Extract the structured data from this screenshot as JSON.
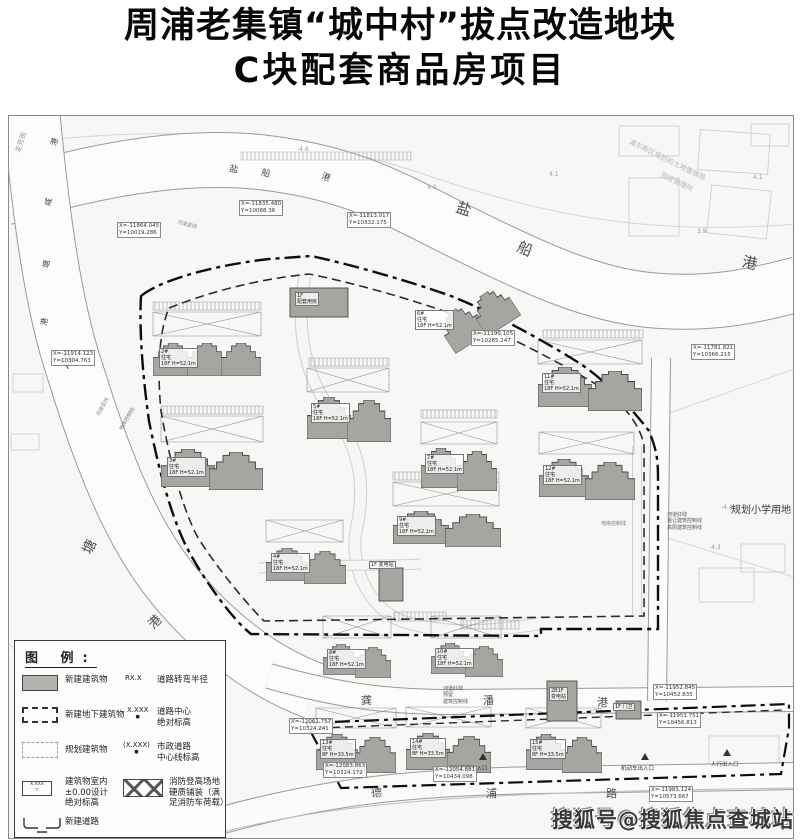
{
  "title": {
    "line1": "周浦老集镇“城中村”拔点改造地块",
    "line2": "C块配套商品房项目"
  },
  "watermark": "搜狐号@搜狐焦点查城站",
  "legend": {
    "title": "图 例:",
    "elev_symbol": "X.XXX",
    "rows": [
      {
        "label": "新建建筑物",
        "sym": "RX.X",
        "symlabel": "道路转弯半径"
      },
      {
        "label": "新建地下建筑物",
        "sym": "X.XXX",
        "dot": "●",
        "symlabel": "道路中心\n绝对标高"
      },
      {
        "label": "规划建筑物",
        "sym": "(X.XXX)",
        "dot": "●",
        "symlabel": "市政道路\n中心线标高"
      },
      {
        "label": "建筑物室内\n±0.00设计\n绝对标高",
        "symlabel": "消防登高场地\n硬质铺装（满\n足消防车荷载）"
      },
      {
        "label": "新建道路"
      }
    ]
  },
  "chars": [
    {
      "t": "盐",
      "x": 447,
      "y": 86,
      "s": 15,
      "r": 18
    },
    {
      "t": "船",
      "x": 508,
      "y": 126,
      "s": 15,
      "r": 24
    },
    {
      "t": "港",
      "x": 733,
      "y": 140,
      "s": 15,
      "r": 12
    },
    {
      "t": "盐",
      "x": 220,
      "y": 50,
      "s": 9,
      "r": 10
    },
    {
      "t": "船",
      "x": 252,
      "y": 54,
      "s": 9,
      "r": 14
    },
    {
      "t": "港",
      "x": 312,
      "y": 58,
      "s": 9,
      "r": 18
    },
    {
      "t": "港",
      "x": 42,
      "y": 22,
      "s": 8,
      "r": -70
    },
    {
      "t": "咸",
      "x": 36,
      "y": 82,
      "s": 8,
      "r": -75
    },
    {
      "t": "塘",
      "x": 34,
      "y": 144,
      "s": 8,
      "r": -80
    },
    {
      "t": "港",
      "x": 32,
      "y": 202,
      "s": 8,
      "r": -80
    },
    {
      "t": "咸",
      "x": 52,
      "y": 238,
      "s": 14,
      "r": -55
    },
    {
      "t": "塘",
      "x": 74,
      "y": 424,
      "s": 14,
      "r": -65
    },
    {
      "t": "港",
      "x": 140,
      "y": 500,
      "s": 13,
      "r": -45
    },
    {
      "t": "龚",
      "x": 352,
      "y": 579,
      "s": 11,
      "r": 0
    },
    {
      "t": "潘",
      "x": 474,
      "y": 579,
      "s": 11,
      "r": 0
    },
    {
      "t": "港",
      "x": 588,
      "y": 581,
      "s": 11,
      "r": 0
    },
    {
      "t": "德",
      "x": 362,
      "y": 671,
      "s": 11,
      "r": 0
    },
    {
      "t": "浦",
      "x": 477,
      "y": 672,
      "s": 11,
      "r": 0
    },
    {
      "t": "路",
      "x": 597,
      "y": 672,
      "s": 11,
      "r": 0
    }
  ],
  "tinylabels": [
    {
      "t": "规划小学用地",
      "x": 722,
      "y": 389,
      "s": 10,
      "c": "#3a3a3a"
    },
    {
      "t": "浦东新区规划和土地管理局",
      "x": 616,
      "y": 40,
      "s": 7,
      "r": 26,
      "c": "#b5b5b2"
    },
    {
      "t": "测绘管理所",
      "x": 650,
      "y": 62,
      "s": 7,
      "r": 26,
      "c": "#b5b5b2"
    },
    {
      "t": "走芳街",
      "x": 2,
      "y": 22,
      "s": 7,
      "r": -72,
      "c": "#999"
    },
    {
      "t": "河道蓝线",
      "x": 168,
      "y": 106,
      "s": 5,
      "r": 14,
      "c": "#888"
    },
    {
      "t": "河道蓝线",
      "x": 84,
      "y": 288,
      "s": 5,
      "r": -62,
      "c": "#888"
    },
    {
      "t": "河道红线\n预留\n建筑控制线",
      "x": 434,
      "y": 570,
      "s": 5,
      "c": "#555"
    },
    {
      "t": "河道红线\n退让建筑控制线\n高层建筑控制线",
      "x": 658,
      "y": 396,
      "s": 5,
      "c": "#555"
    },
    {
      "t": "地库控制线",
      "x": 592,
      "y": 405,
      "s": 5,
      "c": "#777"
    },
    {
      "t": "地库控制线",
      "x": 106,
      "y": 300,
      "s": 5,
      "r": -60,
      "c": "#777"
    },
    {
      "t": "机动车出入口",
      "x": 612,
      "y": 650,
      "s": 5.5,
      "c": "#333"
    },
    {
      "t": "人行出入口",
      "x": 702,
      "y": 646,
      "s": 5.5,
      "c": "#333"
    },
    {
      "t": "消防登高出入口",
      "x": 440,
      "y": 650,
      "s": 5.5,
      "c": "#333"
    },
    {
      "t": "4.1",
      "x": 540,
      "y": 55,
      "s": 6,
      "c": "#999"
    },
    {
      "t": "4.0",
      "x": 418,
      "y": 68,
      "s": 6,
      "c": "#999"
    },
    {
      "t": "-4.6",
      "x": 288,
      "y": 30,
      "s": 6,
      "c": "#999"
    },
    {
      "t": "3.9",
      "x": 688,
      "y": 112,
      "s": 6,
      "c": "#999"
    },
    {
      "t": "-4.1",
      "x": 742,
      "y": 58,
      "s": 6,
      "c": "#999"
    },
    {
      "t": "-4.4",
      "x": 712,
      "y": 388,
      "s": 6,
      "c": "#999"
    },
    {
      "t": "-4.3",
      "x": 700,
      "y": 428,
      "s": 6,
      "c": "#999"
    },
    {
      "t": "1.6",
      "x": 552,
      "y": 692,
      "s": 6,
      "c": "#999"
    }
  ],
  "coords": [
    {
      "t": "X=-11835.480\nY=10088.36",
      "x": 230,
      "y": 84
    },
    {
      "t": "X=-11813.017\nY=10332.175",
      "x": 338,
      "y": 96
    },
    {
      "t": "X=-11864.045\nY=10019.286",
      "x": 108,
      "y": 106
    },
    {
      "t": "X=-11190.105\nY=10285.247",
      "x": 462,
      "y": 214
    },
    {
      "t": "X=-11781.821\nY=10366.215",
      "x": 682,
      "y": 228
    },
    {
      "t": "X=-11914.123\nY=10304.763",
      "x": 42,
      "y": 234
    },
    {
      "t": "X=-11952.845\nY=10452.835",
      "x": 644,
      "y": 568
    },
    {
      "t": "X=-11951.751\nY=10456.813",
      "x": 648,
      "y": 596
    },
    {
      "t": "X=-11983.124\nY=10573.667",
      "x": 640,
      "y": 670
    },
    {
      "t": "X=-12083.863\nY=10324.172",
      "x": 314,
      "y": 646
    },
    {
      "t": "X=-12061.757\nY=10324.241",
      "x": 280,
      "y": 602
    },
    {
      "t": "X=-12054.881\nY=10434.098",
      "x": 424,
      "y": 650
    }
  ],
  "building_labels": [
    {
      "t": "2#\n住宅\n18F H=52.1m",
      "x": 150,
      "y": 232
    },
    {
      "t": "3#\n住宅\n18F H=52.1m",
      "x": 158,
      "y": 341
    },
    {
      "t": "4#\n住宅\n18F H=52.1m",
      "x": 262,
      "y": 437
    },
    {
      "t": "5#\n住宅\n18F H=52.1m",
      "x": 302,
      "y": 287
    },
    {
      "t": "6#\n住宅\n18F H=52.1m",
      "x": 406,
      "y": 194
    },
    {
      "t": "7#\n住宅\n18F H=52.1m",
      "x": 416,
      "y": 338
    },
    {
      "t": "8#\n住宅\n18F H=52.1m",
      "x": 318,
      "y": 533
    },
    {
      "t": "9#\n住宅\n18F H=52.1m",
      "x": 388,
      "y": 400
    },
    {
      "t": "10#\n住宅\n18F H=52.1m",
      "x": 426,
      "y": 532
    },
    {
      "t": "11#\n住宅\n18F H=52.1m",
      "x": 533,
      "y": 257
    },
    {
      "t": "12#\n住宅\n18F H=52.1m",
      "x": 534,
      "y": 349
    },
    {
      "t": "13#\n住宅\n8F H=33.5m",
      "x": 311,
      "y": 623
    },
    {
      "t": "14#\n住宅\n8F H=33.5m",
      "x": 401,
      "y": 622
    },
    {
      "t": "15#\n住宅\n8F H=33.5m",
      "x": 521,
      "y": 623
    },
    {
      "t": "1F\n配套用房",
      "x": 286,
      "y": 176
    },
    {
      "t": "1F 变电站",
      "x": 360,
      "y": 445
    },
    {
      "t": "2B1F\n变电站",
      "x": 540,
      "y": 571
    },
    {
      "t": "1F 门卫",
      "x": 604,
      "y": 587
    }
  ]
}
